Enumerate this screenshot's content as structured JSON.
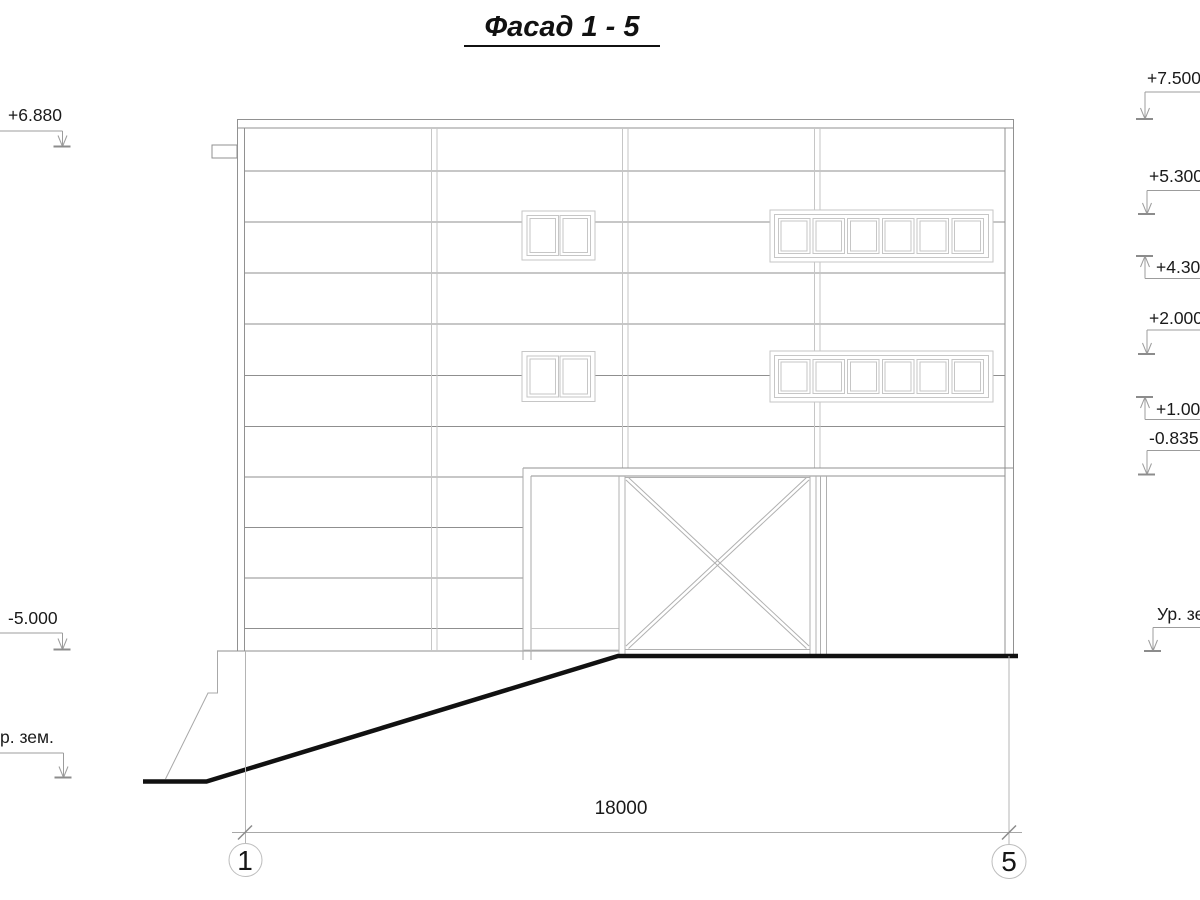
{
  "title": "Фасад 1 - 5",
  "drawing": {
    "dimension_label": "18000",
    "axis_bubbles": [
      {
        "label": "1"
      },
      {
        "label": "5"
      }
    ],
    "elevation_markers": {
      "left": [
        {
          "label": "+6.880",
          "direction": "down"
        },
        {
          "label": "-5.000",
          "direction": "down"
        },
        {
          "label": "р. зем.",
          "direction": "down"
        }
      ],
      "right": [
        {
          "label": "+7.500",
          "direction": "down"
        },
        {
          "label": "+5.300",
          "direction": "down"
        },
        {
          "label": "+4.300",
          "direction": "up"
        },
        {
          "label": "+2.000",
          "direction": "down"
        },
        {
          "label": "+1.000",
          "direction": "up"
        },
        {
          "label": "-0.835",
          "direction": "down"
        },
        {
          "label": "Ур. зе",
          "direction": "down"
        }
      ]
    },
    "colors": {
      "line_thin": "#919191",
      "line_light": "#c6c6c6",
      "line_mid": "#b0b0b0",
      "marker_line": "#9c9c9c",
      "ground_line": "#111111",
      "text": "#1a1a1a"
    }
  }
}
